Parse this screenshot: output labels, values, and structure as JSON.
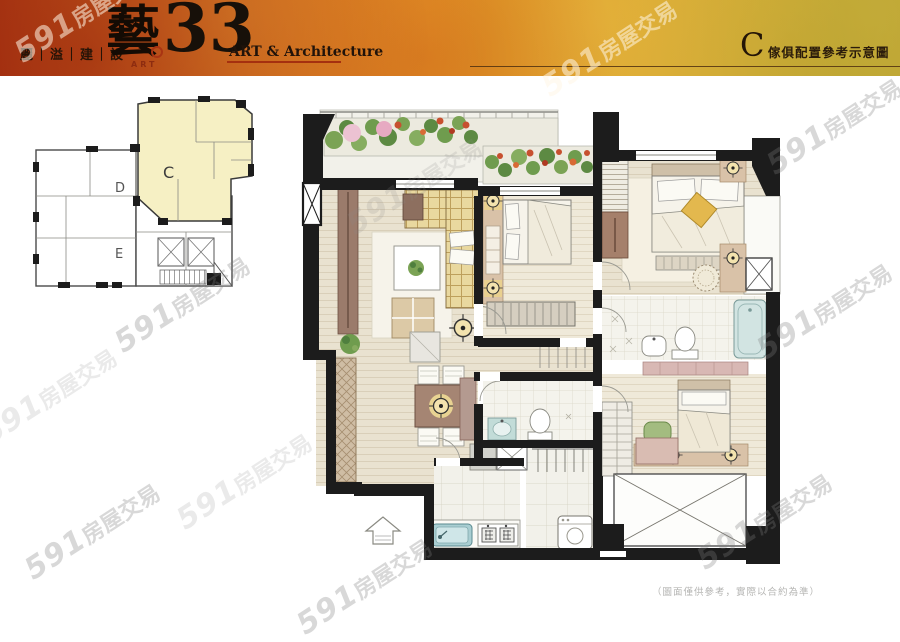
{
  "header": {
    "company": "麗｜溢｜建｜設",
    "logo_character": "藝",
    "logo_art_small": "ART",
    "logo_number": "33",
    "logo_subtitle": "ART & Architecture",
    "unit_label": "C",
    "caption": "傢俱配置參考示意圖"
  },
  "keyplan": {
    "unit_c": "C",
    "unit_d": "D",
    "unit_e": "E"
  },
  "watermark": {
    "prefix": "591",
    "suffix": "房屋交易"
  },
  "footer": {
    "disclaimer": "（圖面僅供參考，實際以合約為準）"
  },
  "colors": {
    "header_accent": "#a5300f",
    "wall": "#1c1c1c",
    "unit_c_fill": "#f6f0c4",
    "wood_floor": "#e9e2d0",
    "sofa_plaid": "#e9d89f",
    "bathtub": "#d2e4e2"
  }
}
